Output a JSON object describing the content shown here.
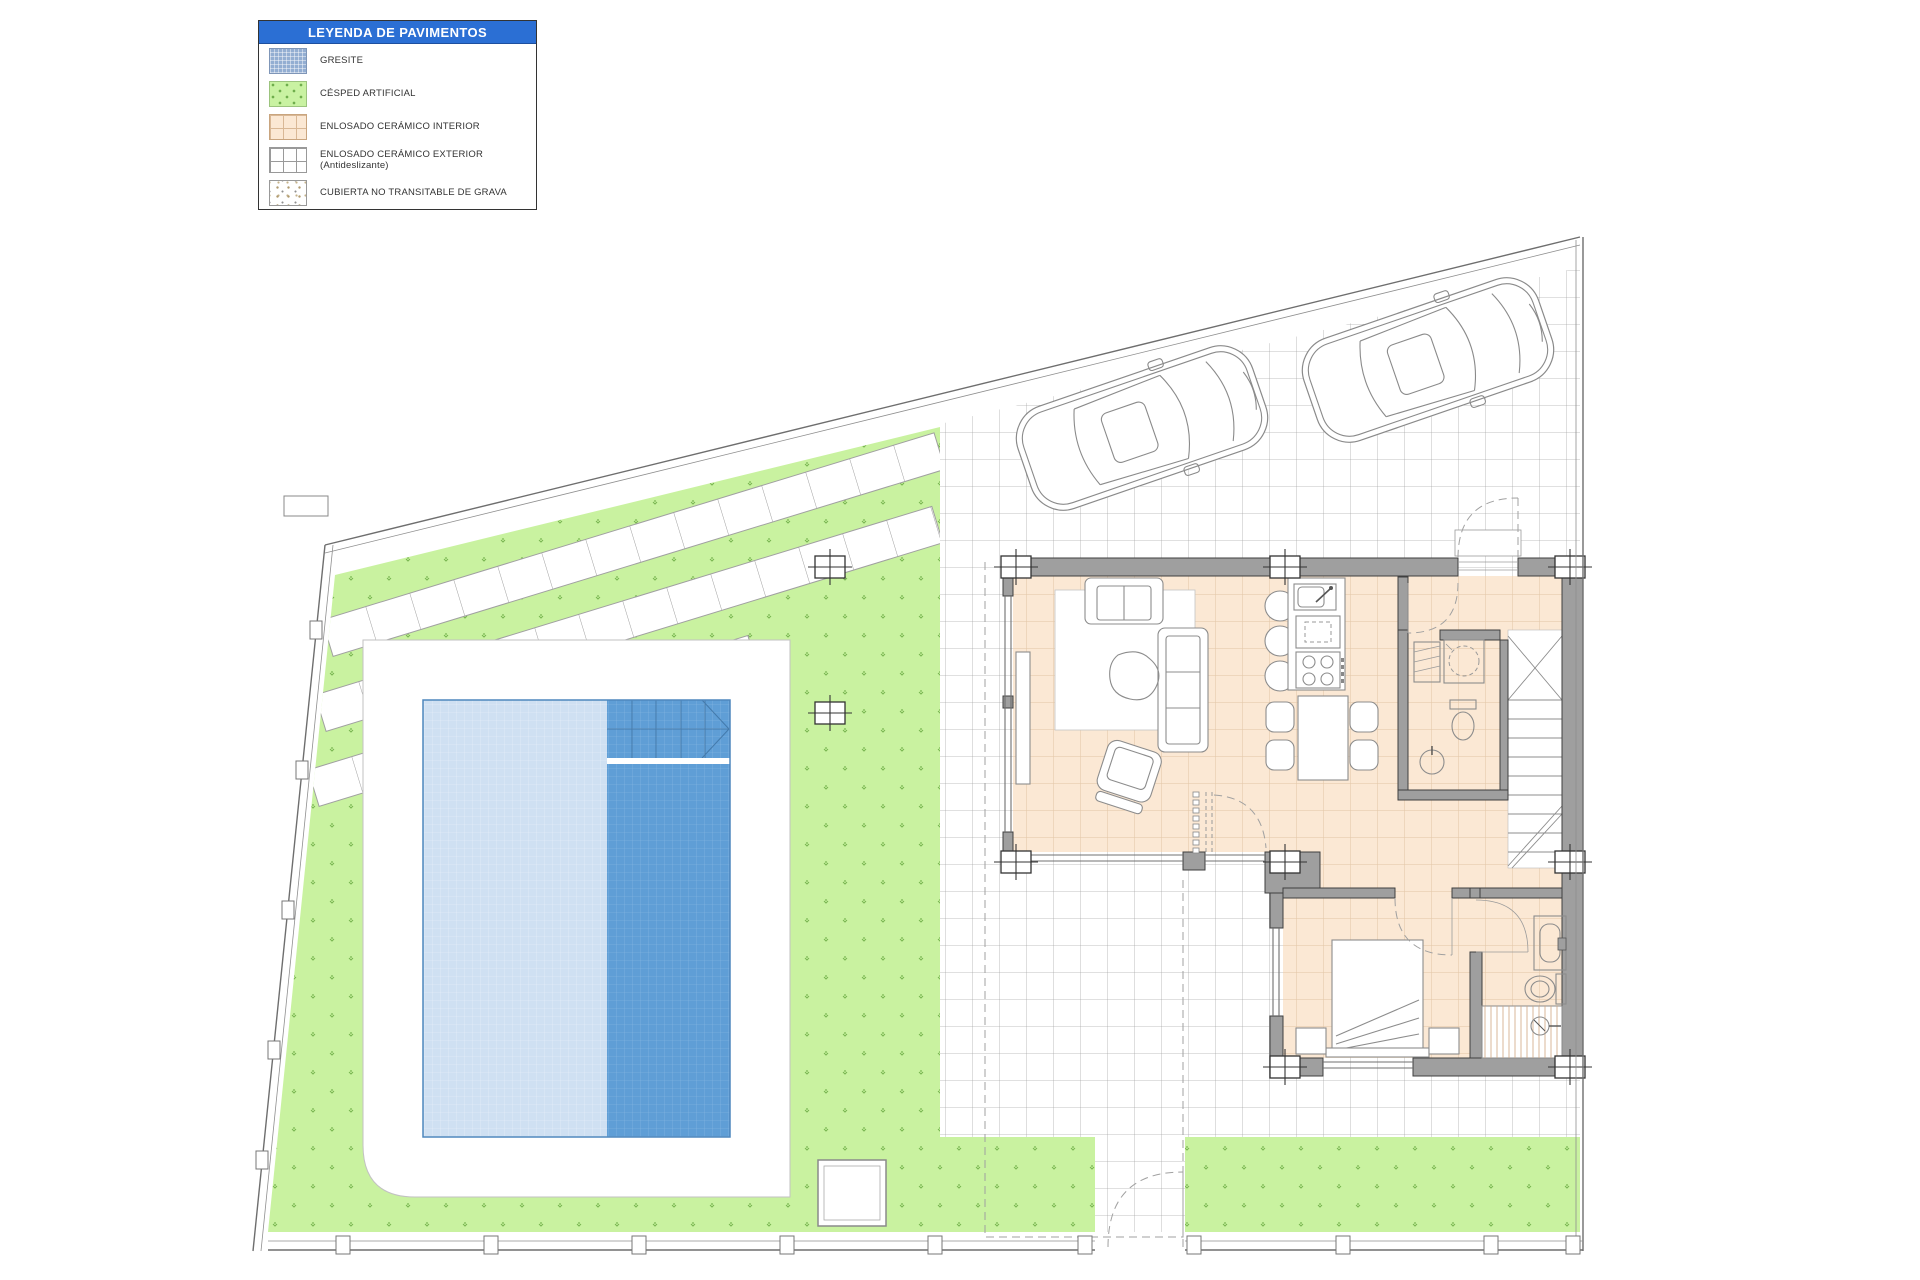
{
  "legend": {
    "title": "LEYENDA DE PAVIMENTOS",
    "title_bg": "#2b6fd4",
    "title_color": "#ffffff",
    "items": [
      {
        "id": "gresite",
        "label": "GRESITE",
        "swatch_color": "#93aed2",
        "pattern": "fine-grid"
      },
      {
        "id": "cesped-artificial",
        "label": "CÉSPED ARTIFICIAL",
        "swatch_color": "#c9f2a2",
        "pattern": "dots"
      },
      {
        "id": "enlosado-ceramico-interior",
        "label": "ENLOSADO CERÁMICO INTERIOR",
        "swatch_color": "#fbe8d4",
        "pattern": "grid"
      },
      {
        "id": "enlosado-ceramico-exterior",
        "label": "ENLOSADO CERÁMICO EXTERIOR (Antideslizante)",
        "swatch_color": "#ffffff",
        "pattern": "grid"
      },
      {
        "id": "cubierta-grava",
        "label": "CUBIERTA NO TRANSITABLE DE GRAVA",
        "swatch_color": "#ffffff",
        "pattern": "speckles"
      }
    ]
  },
  "plan": {
    "colors": {
      "pool_shallow": "#cfe0f2",
      "pool_deep": "#5f9ed6",
      "grass": "#c9f2a0",
      "interior_tile": "#fbe8d4",
      "exterior_tile_line": "#ababab",
      "wall": "#9f9f9f"
    },
    "counts": {
      "cars": 2
    }
  }
}
